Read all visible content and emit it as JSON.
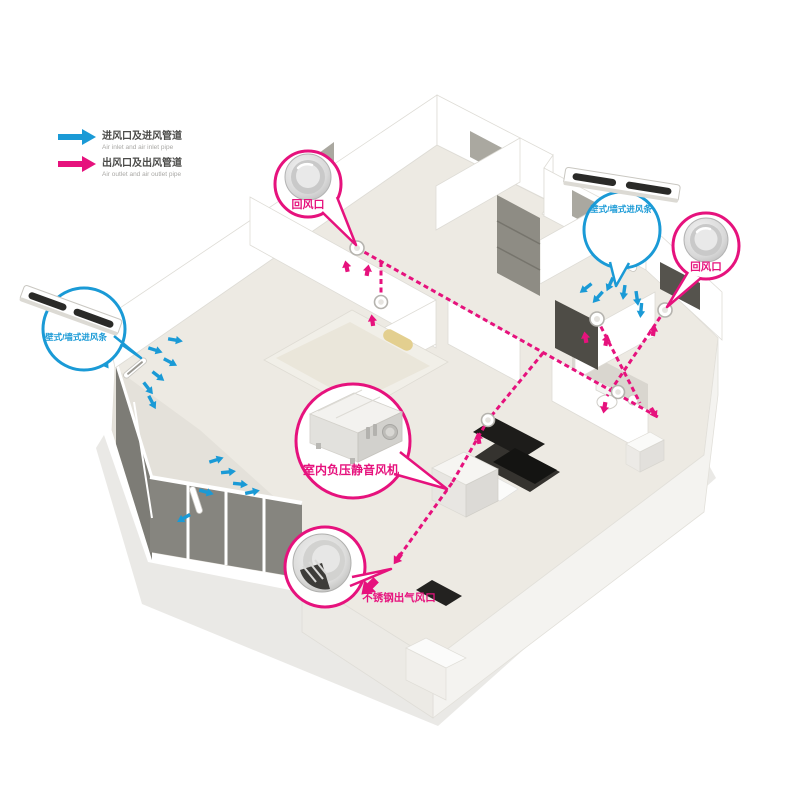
{
  "colors": {
    "inlet_blue": "#1a9ad6",
    "outlet_magenta": "#e6127d"
  },
  "legend": {
    "items": [
      {
        "id": "inlet",
        "zh": "进风口及进风管道",
        "en": "Air inlet and air inlet pipe",
        "color": "#1a9ad6"
      },
      {
        "id": "outlet",
        "zh": "出风口及出风管道",
        "en": "Air outlet and air outlet pipe",
        "color": "#e6127d"
      }
    ]
  },
  "callouts": {
    "return_air_top": {
      "label": "回风口"
    },
    "wall_inlet_right": {
      "label": "壁式/墙式进风条"
    },
    "return_air_right": {
      "label": "回风口"
    },
    "wall_inlet_left": {
      "label": "壁式/墙式进风条"
    },
    "fan_unit": {
      "label": "室内负压静音风机"
    },
    "steel_outlet": {
      "label": "不锈钢出气风口"
    }
  }
}
